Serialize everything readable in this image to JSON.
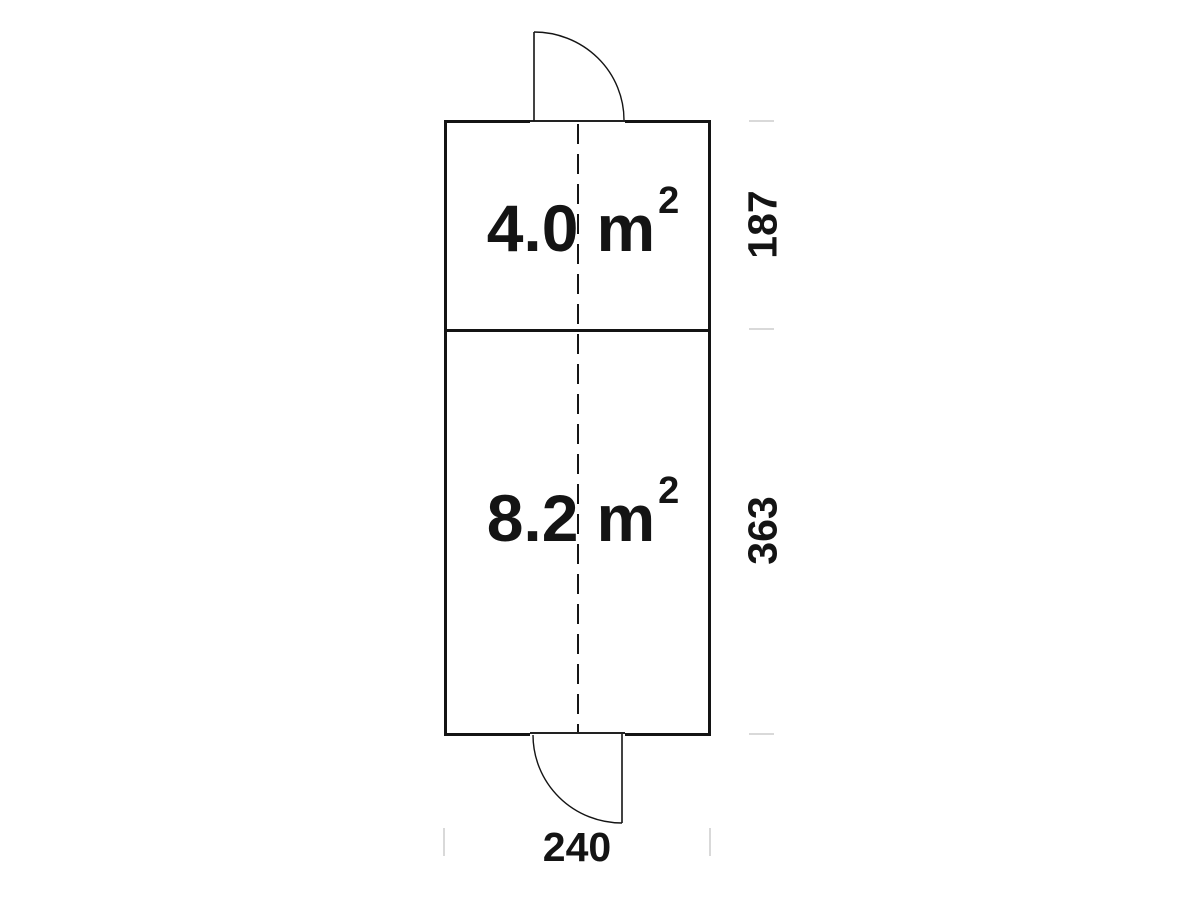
{
  "plan": {
    "rooms": [
      {
        "id": "room-top",
        "area_value": "4.0",
        "area_unit": "m",
        "area_exponent": "2"
      },
      {
        "id": "room-bottom",
        "area_value": "8.2",
        "area_unit": "m",
        "area_exponent": "2"
      }
    ],
    "dimensions": {
      "right_upper": "187",
      "right_lower": "363",
      "bottom_width": "240"
    },
    "features": [
      "top-door-swing",
      "bottom-door-swing",
      "dashed-centerline",
      "room-divider-wall"
    ],
    "colors": {
      "line": "#141414",
      "tick": "#d9d9d9",
      "text": "#141414",
      "background": "#ffffff"
    }
  }
}
